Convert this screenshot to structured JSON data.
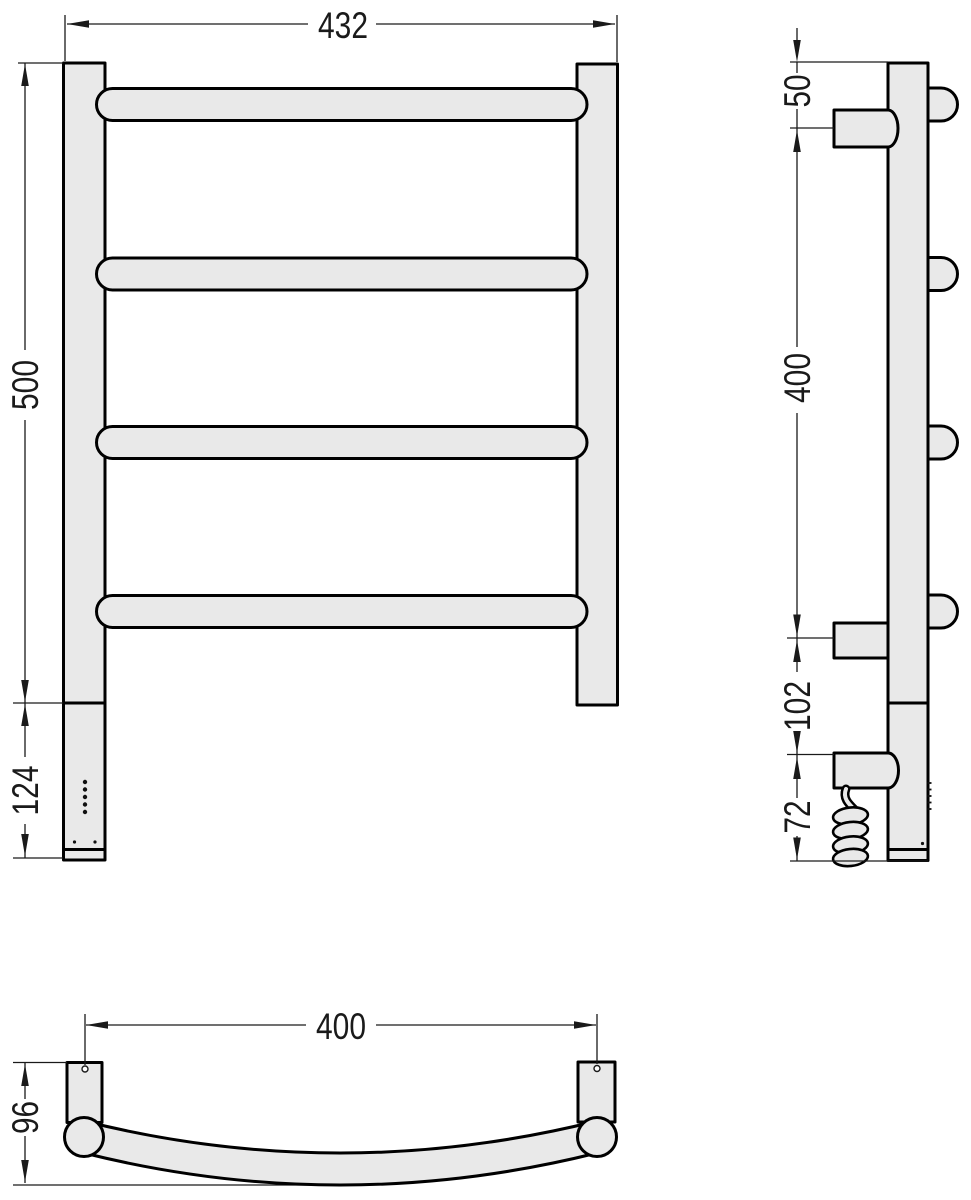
{
  "views": {
    "front": {
      "dim_width": "432",
      "dim_height": "500",
      "dim_lower": "124"
    },
    "side": {
      "dim_top_offset": "50",
      "dim_bracket_span": "400",
      "dim_heater_gap": "102",
      "dim_bottom": "72"
    },
    "plan": {
      "dim_mount_span": "400",
      "dim_depth": "96"
    }
  },
  "colors": {
    "metal_fill": "#e9e9e9",
    "outline": "#000000",
    "dimension": "#1a1a1a",
    "background": "#ffffff"
  }
}
